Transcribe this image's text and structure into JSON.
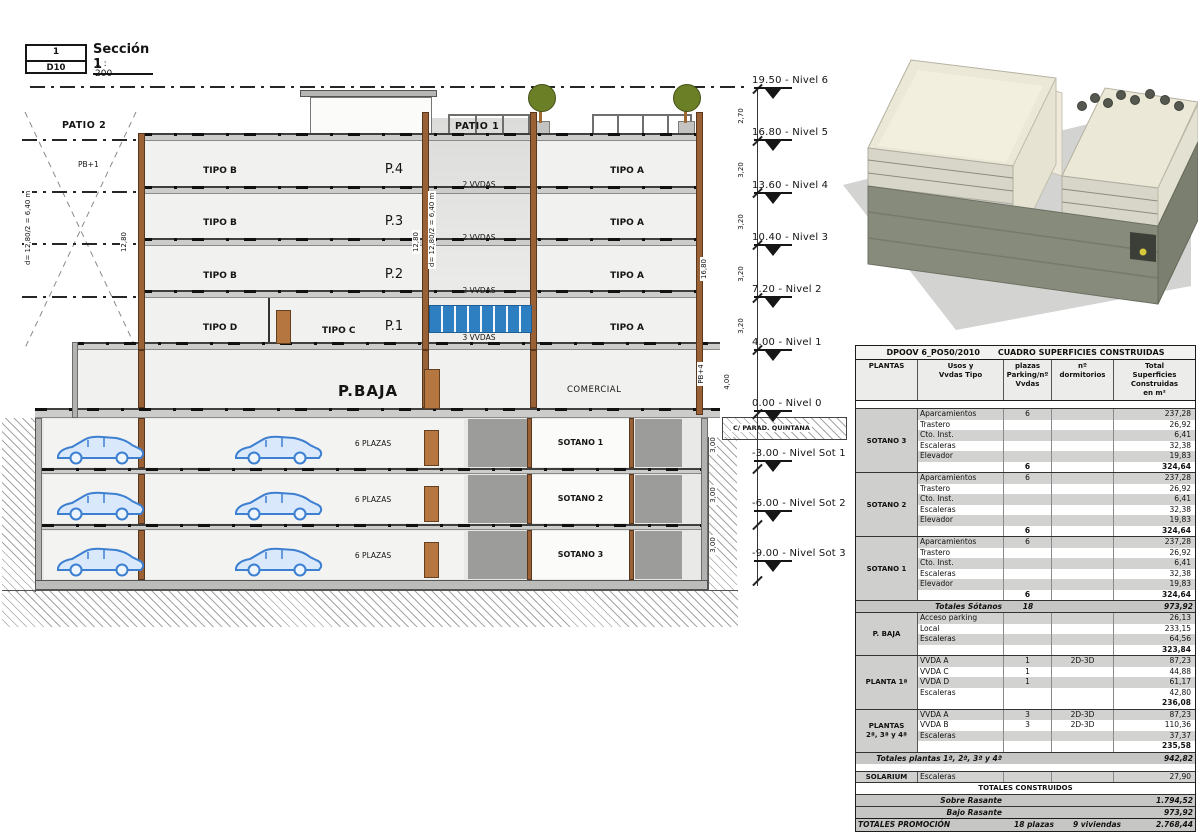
{
  "title_block": {
    "number": "1",
    "sheet_code": "D10",
    "name": "Sección 1",
    "scale": "1 : 200"
  },
  "section": {
    "labels": {
      "patio2": "PATIO 2",
      "patio1": "PATIO 1",
      "pb1": "PB+1",
      "pb4": "PB+4",
      "pbaja": "P.BAJA",
      "comercial": "COMERCIAL",
      "tipo_c": "TIPO C",
      "street": "C/ PARAD. QUINTANA"
    },
    "tipo_left": [
      "TIPO B",
      "TIPO B",
      "TIPO B",
      "TIPO D"
    ],
    "tipo_right": [
      "TIPO A",
      "TIPO A",
      "TIPO A",
      "TIPO A"
    ],
    "p_labels": [
      "P.4",
      "P.3",
      "P.2",
      "P.1"
    ],
    "patio_units": [
      "2 VVDAS",
      "2 VVDAS",
      "2 VVDAS",
      "3 VVDAS"
    ],
    "basement": {
      "plazas": [
        "6 PLAZAS",
        "6 PLAZAS",
        "6 PLAZAS"
      ],
      "names": [
        "SOTANO 1",
        "SOTANO 2",
        "SOTANO 3"
      ]
    }
  },
  "levels": [
    {
      "elev": "19.50",
      "name": "Nivel 6"
    },
    {
      "elev": "16.80",
      "name": "Nivel 5"
    },
    {
      "elev": "13.60",
      "name": "Nivel 4"
    },
    {
      "elev": "10.40",
      "name": "Nivel 3"
    },
    {
      "elev": "7.20",
      "name": "Nivel 2"
    },
    {
      "elev": "4.00",
      "name": "Nivel 1"
    },
    {
      "elev": "0.00",
      "name": "Nivel 0"
    },
    {
      "elev": "-3.00",
      "name": "Nivel Sot 1"
    },
    {
      "elev": "-6.00",
      "name": "Nivel Sot 2"
    },
    {
      "elev": "-9.00",
      "name": "Nivel Sot 3"
    }
  ],
  "dims": {
    "chain": [
      "2,70",
      "3,20",
      "3,20",
      "3,20",
      "3,20",
      "4,00",
      "3,00",
      "3,00",
      "3,00"
    ],
    "total_height": "16,80",
    "patio_width_left": "12,80",
    "patio_width_mid": "12,80",
    "d_left": "d= 12,80/2 = 6,40 m",
    "d_mid": "d= 12,80/2 = 6,40 m"
  },
  "table": {
    "ref": "DPOOV 6_PO50/2010",
    "title": "CUADRO SUPERFICIES CONSTRUIDAS",
    "columns": [
      "PLANTAS",
      "Usos y\nVvdas Tipo",
      "plazas\nParking/nº\nVvdas",
      "nº\ndormitorios",
      "Total\nSuperficies\nConstruidas\nen m²"
    ],
    "blocks": [
      {
        "type": "spacer"
      },
      {
        "type": "group",
        "label": "SOTANO 3",
        "rows": [
          [
            "Aparcamientos",
            "6",
            "",
            "237,28"
          ],
          [
            "Trastero",
            "",
            "",
            "26,92"
          ],
          [
            "Cto. Inst.",
            "",
            "",
            "6,41"
          ],
          [
            "Escaleras",
            "",
            "",
            "32,38"
          ],
          [
            "Elevador",
            "",
            "",
            "19,83"
          ]
        ],
        "subtotal": {
          "plazas": "6",
          "sup": "324,64"
        }
      },
      {
        "type": "group",
        "label": "SOTANO 2",
        "rows": [
          [
            "Aparcamientos",
            "6",
            "",
            "237,28"
          ],
          [
            "Trastero",
            "",
            "",
            "26,92"
          ],
          [
            "Cto. Inst.",
            "",
            "",
            "6,41"
          ],
          [
            "Escaleras",
            "",
            "",
            "32,38"
          ],
          [
            "Elevador",
            "",
            "",
            "19,83"
          ]
        ],
        "subtotal": {
          "plazas": "6",
          "sup": "324,64"
        }
      },
      {
        "type": "group",
        "label": "SOTANO 1",
        "rows": [
          [
            "Aparcamientos",
            "6",
            "",
            "237,28"
          ],
          [
            "Trastero",
            "",
            "",
            "26,92"
          ],
          [
            "Cto. Inst.",
            "",
            "",
            "6,41"
          ],
          [
            "Escaleras",
            "",
            "",
            "32,38"
          ],
          [
            "Elevador",
            "",
            "",
            "19,83"
          ]
        ],
        "subtotal": {
          "plazas": "6",
          "sup": "324,64"
        }
      },
      {
        "type": "total",
        "label": "Totales Sótanos",
        "plazas": "18",
        "sup": "973,92"
      },
      {
        "type": "group",
        "label": "P. BAJA",
        "rows": [
          [
            "Acceso parking",
            "",
            "",
            "26,13"
          ],
          [
            "Local",
            "",
            "",
            "233,15"
          ],
          [
            "Escaleras",
            "",
            "",
            "64,56"
          ]
        ],
        "subtotal": {
          "plazas": "",
          "sup": "323,84"
        }
      },
      {
        "type": "group",
        "label": "PLANTA 1ª",
        "rows": [
          [
            "VVDA A",
            "1",
            "2D-3D",
            "87,23"
          ],
          [
            "VVDA C",
            "1",
            "",
            "44,88"
          ],
          [
            "VVDA D",
            "1",
            "",
            "61,17"
          ],
          [
            "Escaleras",
            "",
            "",
            "42,80"
          ]
        ],
        "subtotal": {
          "plazas": "",
          "sup": "236,08"
        }
      },
      {
        "type": "group",
        "label": "PLANTAS\n2ª, 3ª y 4ª",
        "rows": [
          [
            "VVDA A",
            "3",
            "2D-3D",
            "87,23"
          ],
          [
            "VVDA B",
            "3",
            "2D-3D",
            "110,36"
          ],
          [
            "Escaleras",
            "",
            "",
            "37,37"
          ]
        ],
        "subtotal": {
          "plazas": "",
          "sup": "235,58"
        }
      },
      {
        "type": "total",
        "label": "Totales plantas 1ª, 2ª, 3ª y 4ª",
        "plazas": "",
        "sup": "942,82"
      },
      {
        "type": "spacer"
      },
      {
        "type": "group",
        "label": "SOLARIUM",
        "rows": [
          [
            "Escaleras",
            "",
            "",
            "27,90"
          ]
        ],
        "subtotal": null
      },
      {
        "type": "banner",
        "label": "TOTALES CONSTRUIDOS"
      },
      {
        "type": "total",
        "label": "Sobre Rasante",
        "plazas": "",
        "sup": "1.794,52"
      },
      {
        "type": "total",
        "label": "Bajo Rasante",
        "plazas": "",
        "sup": "973,92"
      },
      {
        "type": "final",
        "label": "TOTALES PROMOCIÓN",
        "plazas": "18 plazas",
        "dorm": "9 viviendas",
        "sup": "2.768,44"
      }
    ]
  }
}
